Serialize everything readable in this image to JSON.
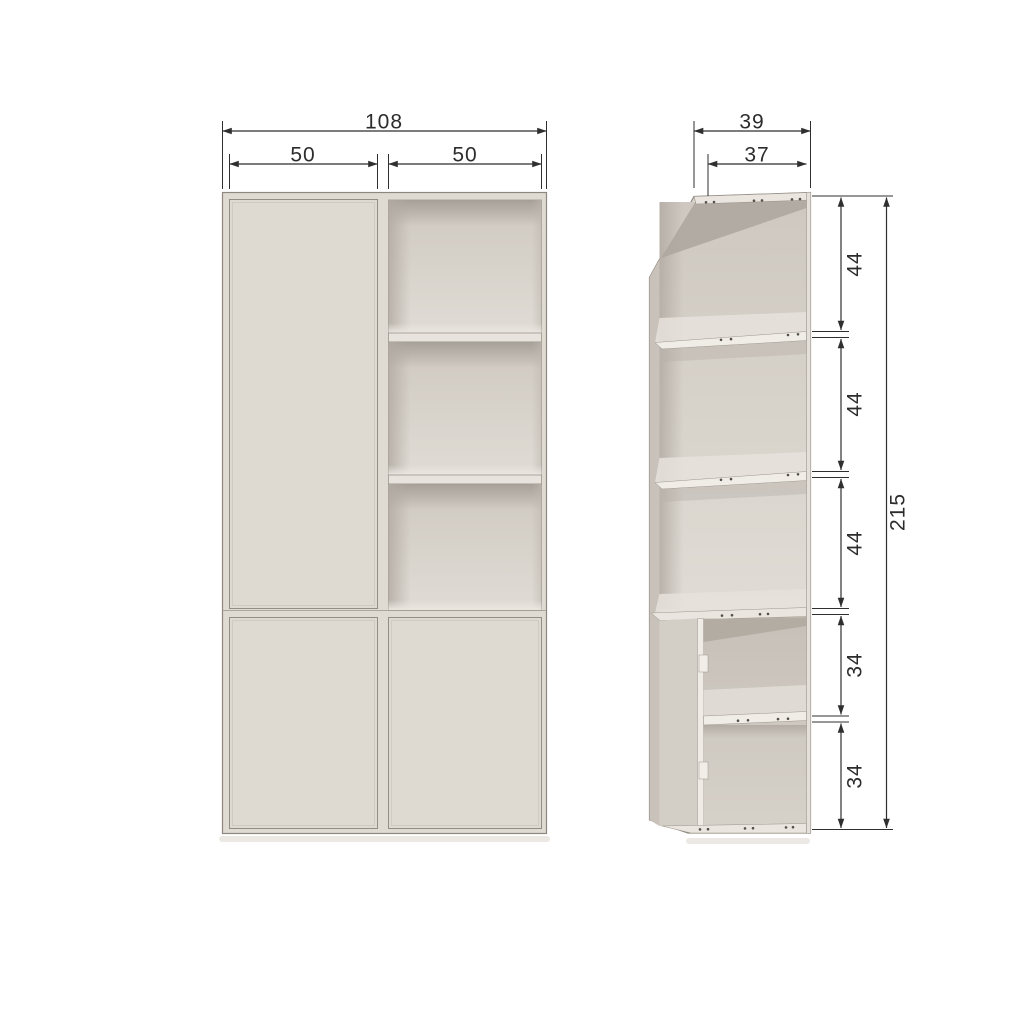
{
  "front_view": {
    "total_width": "108",
    "left_section_width": "50",
    "right_section_width": "50"
  },
  "side_view": {
    "total_depth": "39",
    "inner_depth": "37",
    "section_heights": [
      "44",
      "44",
      "44",
      "34",
      "34"
    ],
    "total_height": "215"
  },
  "colors": {
    "background": "#ffffff",
    "cabinet_body": "#dedad2",
    "cabinet_interior": "#d5d0c8",
    "edge_line": "#8d877f",
    "dimension_line": "#2f2f2f"
  }
}
